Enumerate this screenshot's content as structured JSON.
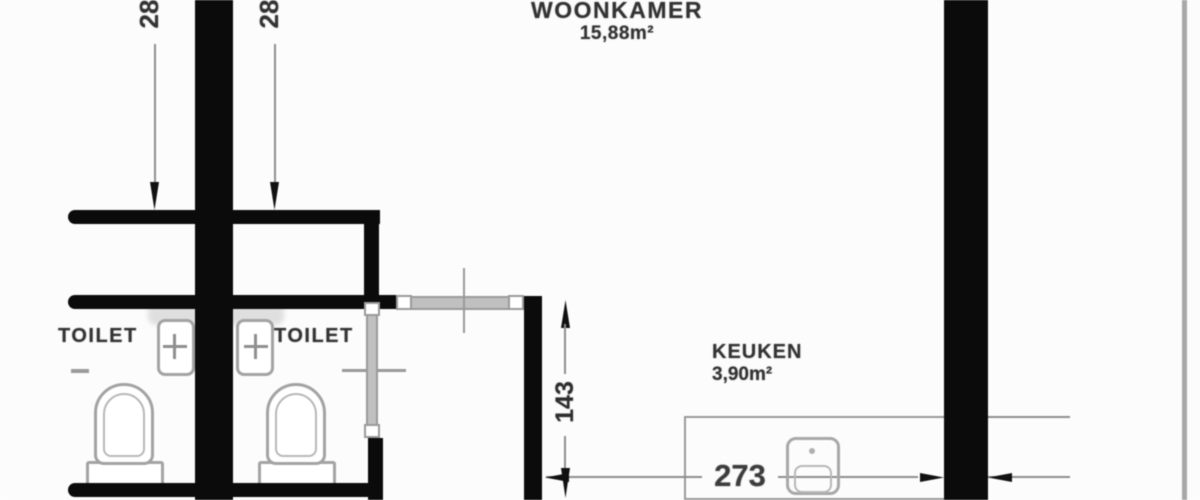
{
  "rooms": {
    "woonkamer": {
      "label": "WOONKAMER",
      "area": "15,88m²"
    },
    "keuken": {
      "label": "KEUKEN",
      "area": "3,90m²"
    },
    "toilet_left": {
      "label": "TOILET"
    },
    "toilet_right": {
      "label": "TOILET"
    }
  },
  "dimensions": {
    "wall_offset_left": "28",
    "wall_offset_right": "28",
    "passage_depth": "143",
    "kitchen_width": "273"
  },
  "colors": {
    "wall": "#0b0b0b",
    "dimension_line": "#8e8e8e",
    "fixture_outline": "#a3a3a3",
    "window_fill": "#c0c0c0",
    "label_text": "#333333",
    "background": "#fcfcfc",
    "edge_line": "#a8a8a8"
  },
  "icons": {
    "toilet-icon": "arch-outline-with-pedestal-base",
    "washbasin-icon": "rounded-square-with-tap-cross",
    "kitchen-sink-icon": "rounded-square-with-bowl",
    "window-icon": "gray-band-with-white-end-blocks",
    "door-icon": "gray-strip-with-hinge-blocks",
    "dimension-arrow-icon": "thin-spike-triangle"
  }
}
